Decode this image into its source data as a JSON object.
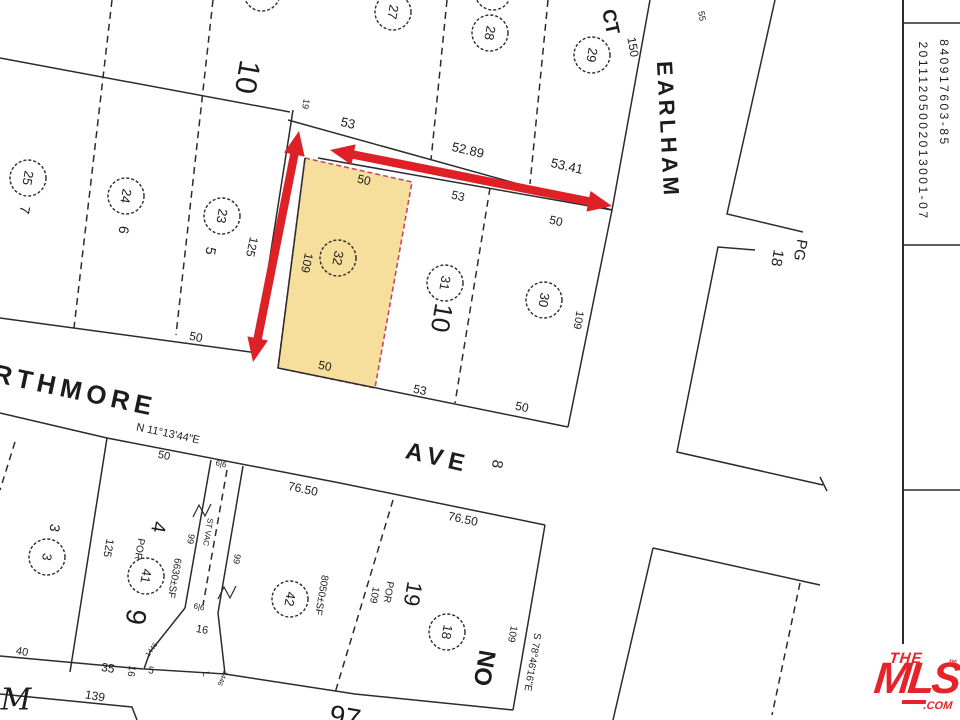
{
  "map": {
    "paper": "#ffffff",
    "ink": "#2b2b2b",
    "arrow_color": "#DE2027",
    "parcel": {
      "points": [
        [
          305,
          158
        ],
        [
          412,
          182
        ],
        [
          375,
          388
        ],
        [
          278,
          368
        ]
      ],
      "fill": "#F6DF9C",
      "stroke": "#BF4A63",
      "lot_number": "32"
    },
    "lines": [
      {
        "p": [
          [
            0,
            58
          ],
          [
            290,
            112
          ]
        ]
      },
      {
        "p": [
          [
            112,
            0
          ],
          [
            74,
            328
          ]
        ],
        "dash": true
      },
      {
        "p": [
          [
            213,
            0
          ],
          [
            176,
            335
          ]
        ],
        "dash": true
      },
      {
        "p": [
          [
            0,
            318
          ],
          [
            258,
            353
          ]
        ]
      },
      {
        "p": [
          [
            293,
            110
          ],
          [
            255,
            353
          ]
        ]
      },
      {
        "p": [
          [
            288,
            120
          ],
          [
            612,
            210
          ]
        ]
      },
      {
        "p": [
          [
            447,
            0
          ],
          [
            431,
            160
          ]
        ],
        "dash": true
      },
      {
        "p": [
          [
            548,
            0
          ],
          [
            530,
            184
          ]
        ],
        "dash": true
      },
      {
        "p": [
          [
            650,
            0
          ],
          [
            612,
            210
          ],
          [
            568,
            427
          ]
        ],
        "n": "earlham-west-edge"
      },
      {
        "p": [
          [
            318,
            158
          ],
          [
            612,
            210
          ]
        ]
      },
      {
        "p": [
          [
            490,
            188
          ],
          [
            455,
            403
          ]
        ],
        "dash": true
      },
      {
        "p": [
          [
            278,
            368
          ],
          [
            568,
            427
          ]
        ]
      },
      {
        "p": [
          [
            305,
            158
          ],
          [
            278,
            368
          ]
        ]
      },
      {
        "p": [
          [
            775,
            0
          ],
          [
            727,
            214
          ],
          [
            803,
            232
          ]
        ],
        "n": "earlham-east-edge"
      },
      {
        "p": [
          [
            755,
            250
          ],
          [
            718,
            247
          ],
          [
            677,
            452
          ],
          [
            823,
            485
          ]
        ]
      },
      {
        "p": [
          [
            820,
            477
          ],
          [
            827,
            491
          ]
        ]
      },
      {
        "p": [
          [
            653,
            548
          ],
          [
            820,
            585
          ]
        ]
      },
      {
        "p": [
          [
            653,
            548
          ],
          [
            613,
            720
          ]
        ]
      },
      {
        "p": [
          [
            800,
            583
          ],
          [
            772,
            715
          ]
        ],
        "dash": true
      },
      {
        "p": [
          [
            0,
            413
          ],
          [
            107,
            438
          ],
          [
            340,
            483
          ],
          [
            545,
            525
          ]
        ],
        "n": "ave-south-edge"
      },
      {
        "p": [
          [
            545,
            525
          ],
          [
            513,
            710
          ]
        ]
      },
      {
        "p": [
          [
            225,
            674
          ],
          [
            355,
            694
          ],
          [
            513,
            710
          ]
        ]
      },
      {
        "p": [
          [
            393,
            500
          ],
          [
            335,
            693
          ]
        ],
        "dash": true
      },
      {
        "p": [
          [
            107,
            438
          ],
          [
            70,
            672
          ]
        ]
      },
      {
        "p": [
          [
            0,
            656
          ],
          [
            143,
            669
          ]
        ]
      },
      {
        "p": [
          [
            185,
            608
          ],
          [
            150,
            652
          ],
          [
            144,
            669
          ],
          [
            225,
            674
          ],
          [
            218,
            613
          ]
        ],
        "n": "vacated-strip-flag"
      },
      {
        "p": [
          [
            211,
            460
          ],
          [
            185,
            608
          ]
        ]
      },
      {
        "p": [
          [
            243,
            466
          ],
          [
            218,
            613
          ]
        ]
      },
      {
        "p": [
          [
            227,
            470
          ],
          [
            203,
            605
          ]
        ],
        "dash": true
      },
      {
        "p": [
          [
            0,
            694
          ],
          [
            132,
            707
          ],
          [
            137,
            720
          ]
        ]
      },
      {
        "p": [
          [
            15,
            442
          ],
          [
            0,
            490
          ]
        ],
        "dash": true
      },
      {
        "p": [
          [
            903,
            0
          ],
          [
            903,
            720
          ]
        ],
        "w": 2,
        "n": "sheet-divider-line"
      },
      {
        "p": [
          [
            903,
            23
          ],
          [
            960,
            23
          ]
        ],
        "n": "sheet-tick-line"
      },
      {
        "p": [
          [
            903,
            245
          ],
          [
            960,
            245
          ]
        ],
        "n": "sheet-tick-line"
      },
      {
        "p": [
          [
            903,
            490
          ],
          [
            960,
            490
          ]
        ],
        "n": "sheet-tick-line"
      }
    ],
    "circles": [
      {
        "x": 28,
        "y": 178,
        "t": "25"
      },
      {
        "x": 126,
        "y": 196,
        "t": "24"
      },
      {
        "x": 222,
        "y": 216,
        "t": "23"
      },
      {
        "x": 393,
        "y": 12,
        "t": "27"
      },
      {
        "x": 490,
        "y": 33,
        "t": "28"
      },
      {
        "x": 592,
        "y": 55,
        "t": "29"
      },
      {
        "x": 338,
        "y": 258,
        "t": "32"
      },
      {
        "x": 445,
        "y": 283,
        "t": "31"
      },
      {
        "x": 544,
        "y": 300,
        "t": "30"
      },
      {
        "x": 47,
        "y": 557,
        "t": "3"
      },
      {
        "x": 146,
        "y": 576,
        "t": "41"
      },
      {
        "x": 290,
        "y": 599,
        "t": "42"
      },
      {
        "x": 447,
        "y": 632,
        "t": "18"
      },
      {
        "x": 262,
        "y": -7,
        "t": ""
      },
      {
        "x": 493,
        "y": -8,
        "t": ""
      }
    ],
    "labels": [
      {
        "t": "10",
        "x": 247,
        "y": 77,
        "r": 100,
        "s": 30,
        "n": "block-number-10"
      },
      {
        "t": "19",
        "x": 306,
        "y": 104,
        "r": 100,
        "s": 9
      },
      {
        "t": "53",
        "x": 348,
        "y": 123,
        "r": 13,
        "s": 13
      },
      {
        "t": "52.89",
        "x": 468,
        "y": 150,
        "r": 13,
        "s": 13
      },
      {
        "t": "53.41",
        "x": 567,
        "y": 166,
        "r": 13,
        "s": 13
      },
      {
        "t": "CT",
        "x": 610,
        "y": 22,
        "r": 78,
        "s": 19,
        "w": 600,
        "n": "street-name-ct"
      },
      {
        "t": "55",
        "x": 702,
        "y": 16,
        "r": 80,
        "s": 9
      },
      {
        "t": "150",
        "x": 633,
        "y": 47,
        "r": 80,
        "s": 12
      },
      {
        "t": "EARLHAM",
        "x": 668,
        "y": 130,
        "r": 87,
        "s": 22,
        "ls": 4,
        "w": 600,
        "n": "street-name-earlham"
      },
      {
        "t": "PG",
        "x": 800,
        "y": 250,
        "r": 100,
        "s": 15,
        "n": "pg-label"
      },
      {
        "t": "18",
        "x": 777,
        "y": 258,
        "r": 100,
        "s": 15,
        "n": "pg-number"
      },
      {
        "t": "50",
        "x": 364,
        "y": 180,
        "r": 13,
        "s": 12
      },
      {
        "t": "53",
        "x": 458,
        "y": 196,
        "r": 13,
        "s": 12
      },
      {
        "t": "50",
        "x": 556,
        "y": 221,
        "r": 13,
        "s": 12
      },
      {
        "t": "109",
        "x": 307,
        "y": 263,
        "r": 102,
        "s": 12
      },
      {
        "t": "125",
        "x": 252,
        "y": 247,
        "r": 102,
        "s": 12
      },
      {
        "t": "10",
        "x": 442,
        "y": 318,
        "r": 100,
        "s": 26,
        "n": "block-number-10-lower"
      },
      {
        "t": "109",
        "x": 578,
        "y": 320,
        "r": 100,
        "s": 11
      },
      {
        "t": "50",
        "x": 196,
        "y": 337,
        "r": 12,
        "s": 12
      },
      {
        "t": "50",
        "x": 325,
        "y": 366,
        "r": 12,
        "s": 12
      },
      {
        "t": "53",
        "x": 420,
        "y": 390,
        "r": 12,
        "s": 12
      },
      {
        "t": "50",
        "x": 522,
        "y": 407,
        "r": 12,
        "s": 12
      },
      {
        "t": "RTHMORE",
        "x": 75,
        "y": 390,
        "r": 12,
        "s": 26,
        "ls": 5,
        "w": 600,
        "n": "street-name-swarthmore"
      },
      {
        "t": "N 11°13'44\"E",
        "x": 168,
        "y": 434,
        "r": 12,
        "s": 11,
        "n": "bearing-north"
      },
      {
        "t": "50",
        "x": 164,
        "y": 456,
        "r": 12,
        "s": 11
      },
      {
        "t": "AVE",
        "x": 438,
        "y": 458,
        "r": 13,
        "s": 24,
        "ls": 6,
        "w": 600,
        "n": "street-name-ave"
      },
      {
        "t": "8",
        "x": 497,
        "y": 464,
        "r": 100,
        "s": 15
      },
      {
        "t": "76.50",
        "x": 303,
        "y": 489,
        "r": 12,
        "s": 12
      },
      {
        "t": "76.50",
        "x": 463,
        "y": 519,
        "r": 12,
        "s": 12
      },
      {
        "t": "3",
        "x": 55,
        "y": 528,
        "r": 100,
        "s": 14
      },
      {
        "t": "125",
        "x": 108,
        "y": 548,
        "r": 100,
        "s": 11
      },
      {
        "t": "POR",
        "x": 139,
        "y": 549,
        "r": 100,
        "s": 10
      },
      {
        "t": "4",
        "x": 158,
        "y": 527,
        "r": 100,
        "s": 20
      },
      {
        "t": "9",
        "x": 136,
        "y": 617,
        "r": 100,
        "s": 28
      },
      {
        "t": "6630±SF",
        "x": 174,
        "y": 578,
        "r": 100,
        "s": 10
      },
      {
        "t": "99",
        "x": 191,
        "y": 539,
        "r": 100,
        "s": 9
      },
      {
        "t": "99",
        "x": 237,
        "y": 559,
        "r": 100,
        "s": 9
      },
      {
        "t": "ST VAC",
        "x": 208,
        "y": 532,
        "r": 100,
        "s": 8
      },
      {
        "t": "8050±SF",
        "x": 321,
        "y": 595,
        "r": 100,
        "s": 10
      },
      {
        "t": "POR",
        "x": 388,
        "y": 592,
        "r": 100,
        "s": 10
      },
      {
        "t": "109",
        "x": 374,
        "y": 595,
        "r": 100,
        "s": 10
      },
      {
        "t": "19",
        "x": 413,
        "y": 594,
        "r": 100,
        "s": 22
      },
      {
        "t": "NO",
        "x": 484,
        "y": 668,
        "r": 100,
        "s": 24,
        "w": 600,
        "n": "street-name-partial-no"
      },
      {
        "t": "109",
        "x": 512,
        "y": 634,
        "r": 100,
        "s": 10
      },
      {
        "t": "S 78°46'16\"E",
        "x": 532,
        "y": 662,
        "r": 100,
        "s": 10,
        "n": "bearing-south"
      },
      {
        "t": "40",
        "x": 22,
        "y": 652,
        "r": 10,
        "s": 11
      },
      {
        "t": "35",
        "x": 108,
        "y": 668,
        "r": 10,
        "s": 12
      },
      {
        "t": "16",
        "x": 131,
        "y": 671,
        "r": 100,
        "s": 10
      },
      {
        "t": "5",
        "x": 151,
        "y": 671,
        "r": 10,
        "s": 10
      },
      {
        "t": "16",
        "x": 202,
        "y": 630,
        "r": 10,
        "s": 11
      },
      {
        "t": "139",
        "x": 95,
        "y": 696,
        "r": 10,
        "s": 12
      },
      {
        "t": "M",
        "x": 16,
        "y": 700,
        "r": 0,
        "s": 30,
        "i": 1,
        "serif": 1,
        "n": "street-name-partial-m"
      },
      {
        "t": "97",
        "x": 345,
        "y": 717,
        "r": 10,
        "s": 28
      },
      {
        "t": "7",
        "x": 25,
        "y": 210,
        "r": 100,
        "s": 14
      },
      {
        "t": "6",
        "x": 124,
        "y": 230,
        "r": 100,
        "s": 14
      },
      {
        "t": "5",
        "x": 211,
        "y": 251,
        "r": 100,
        "s": 14
      },
      {
        "t": "6|6",
        "x": 221,
        "y": 464,
        "r": 12,
        "s": 8
      },
      {
        "t": "6|6",
        "x": 199,
        "y": 607,
        "r": 12,
        "s": 8
      },
      {
        "t": "1446",
        "x": 152,
        "y": 650,
        "r": -55,
        "s": 7
      },
      {
        "t": "1446",
        "x": 222,
        "y": 678,
        "r": 115,
        "s": 7
      },
      {
        "t": "L",
        "x": 206,
        "y": 674,
        "r": 80,
        "s": 9
      },
      {
        "t": "840917603-85",
        "x": 944,
        "y": 93,
        "r": 90,
        "s": 12,
        "ls": 2.5,
        "n": "plat-id-1"
      },
      {
        "t": "20111205002013001-07",
        "x": 923,
        "y": 131,
        "r": 90,
        "s": 12,
        "ls": 2.5,
        "n": "plat-id-2"
      }
    ],
    "zigzags": [
      {
        "x": 202,
        "y": 510
      },
      {
        "x": 227,
        "y": 592
      }
    ],
    "arrows": [
      {
        "x1": 299,
        "y1": 131,
        "x2": 253,
        "y2": 362,
        "n": "red-arrow-lot-depth"
      },
      {
        "x1": 330,
        "y1": 150,
        "x2": 612,
        "y2": 206,
        "n": "red-arrow-lot-frontage"
      }
    ]
  },
  "watermark": {
    "the": "THE",
    "mls": "MLS",
    "tm": "™",
    "com": ".COM",
    "color": "#E4232B"
  }
}
